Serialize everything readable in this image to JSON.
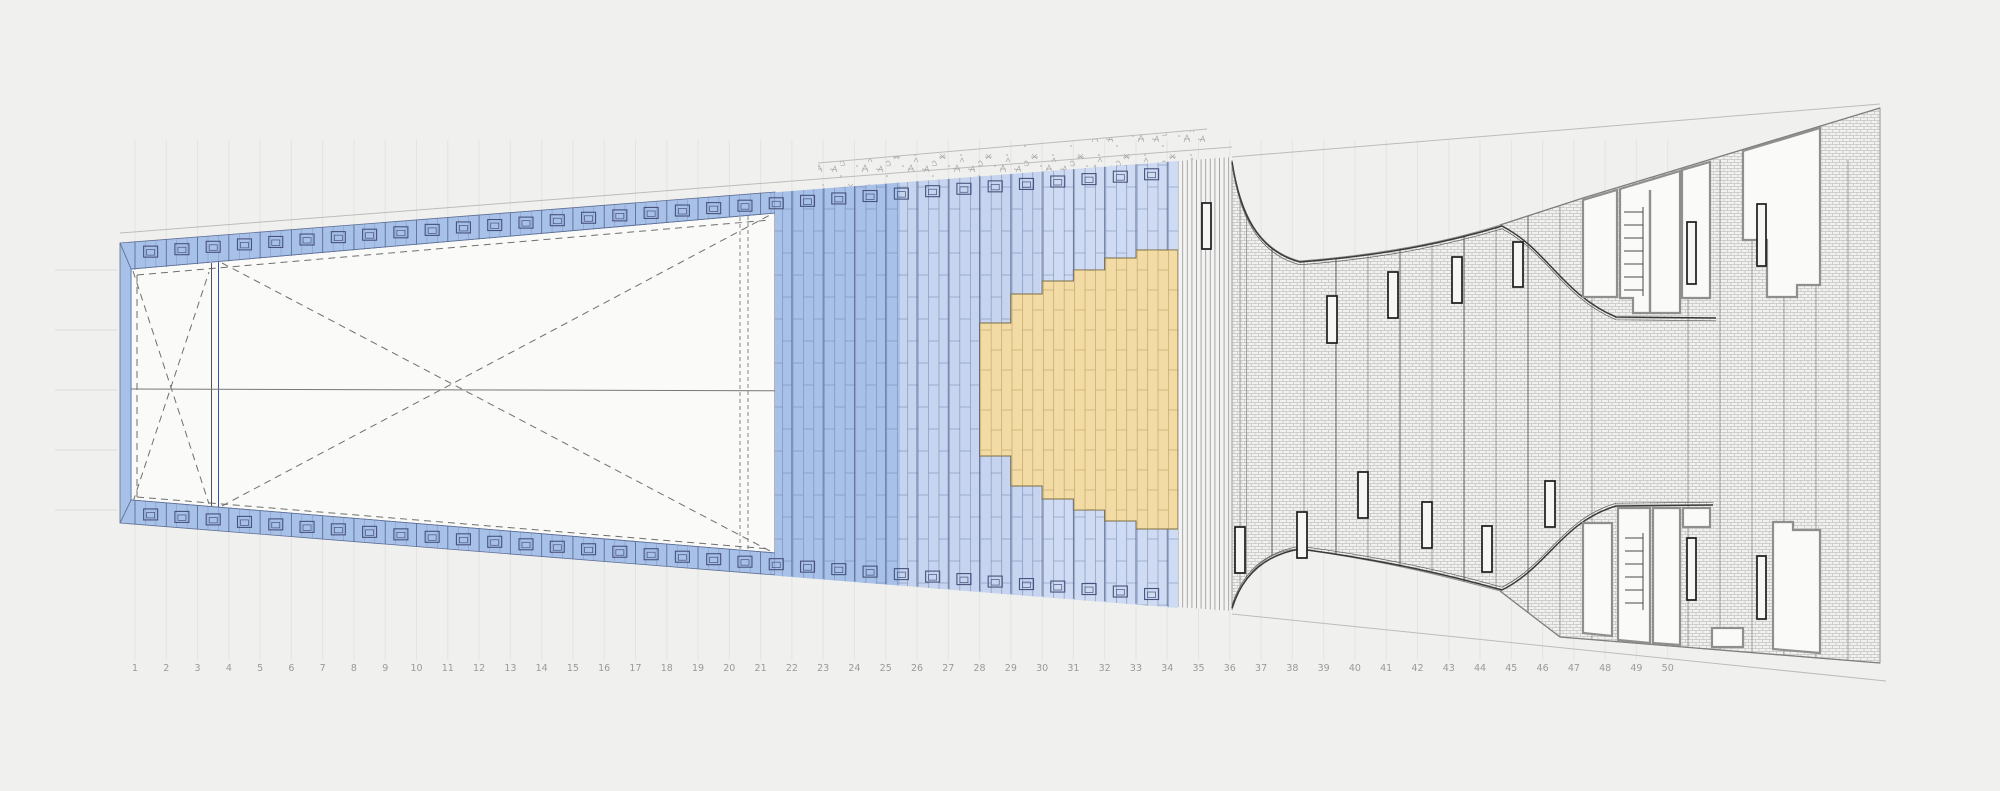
{
  "document": {
    "type": "architectural-site-plan",
    "scale": {
      "numbers": [
        "1",
        "2",
        "3",
        "4",
        "5",
        "6",
        "7",
        "8",
        "9",
        "10",
        "11",
        "12",
        "13",
        "14",
        "15",
        "16",
        "17",
        "18",
        "19",
        "20",
        "21",
        "22",
        "23",
        "24",
        "25",
        "26",
        "27",
        "28",
        "29",
        "30",
        "31",
        "32",
        "33",
        "34",
        "35",
        "36",
        "37",
        "38",
        "39",
        "40",
        "41",
        "42",
        "43",
        "44",
        "45",
        "46",
        "47",
        "48",
        "49",
        "50"
      ]
    },
    "colors": {
      "background": "#f0f0ee",
      "plan_white": "#fafaf8",
      "deck_blue": "#a8c1e8",
      "deck_blue_mid": "#c6d4ef",
      "deck_blue_light": "#cfdbf2",
      "timber_yellow": "#f2dba4",
      "line_blue": "#5d6f96",
      "block_blue": "#46527c",
      "hatch_line": "#a9a9a7",
      "curve_dark": "#3a3a3a",
      "room_border": "#8f8f8d",
      "site_line": "#bcbcba",
      "vegetation": "#a6a6a4",
      "label_gray": "#9a9a9a",
      "rooflight_black": "#1c1c1c"
    }
  }
}
